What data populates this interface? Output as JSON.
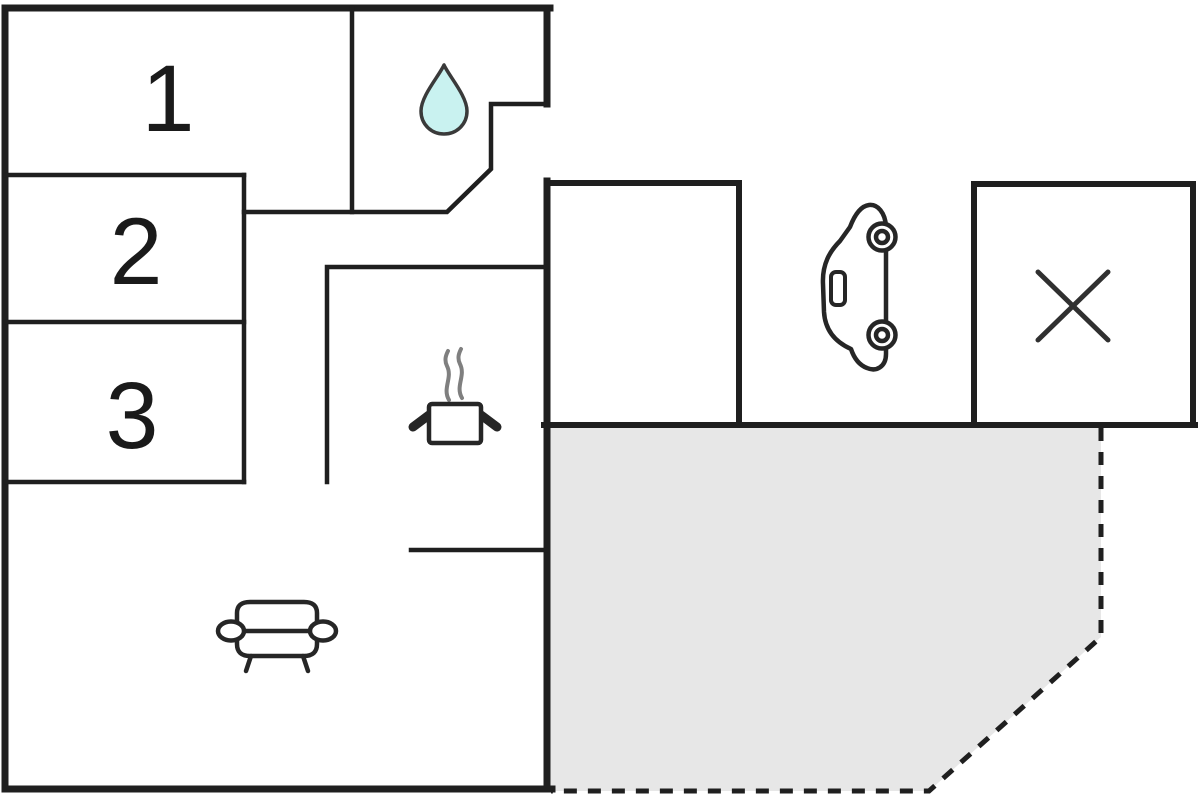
{
  "title": "Floor plan",
  "colors": {
    "wall": "#1f1f1f",
    "background": "#ffffff",
    "terrace_fill": "#e7e7e7",
    "water_drop_fill": "#c9f2f0",
    "steam": "#7f7f7f"
  },
  "plan": {
    "rooms": [
      {
        "name": "room-1",
        "label": "1"
      },
      {
        "name": "room-2",
        "label": "2"
      },
      {
        "name": "room-3",
        "label": "3"
      }
    ],
    "areas": [
      {
        "name": "bathroom",
        "icon": "water-drop-icon"
      },
      {
        "name": "kitchen",
        "icon": "cooking-pot-icon"
      },
      {
        "name": "living-room",
        "icon": "sofa-icon"
      },
      {
        "name": "carport",
        "icon": "car-icon"
      },
      {
        "name": "outbuilding",
        "icon": "x-mark-icon"
      },
      {
        "name": "terrace",
        "style": "shaded-dashed-outline"
      }
    ]
  }
}
